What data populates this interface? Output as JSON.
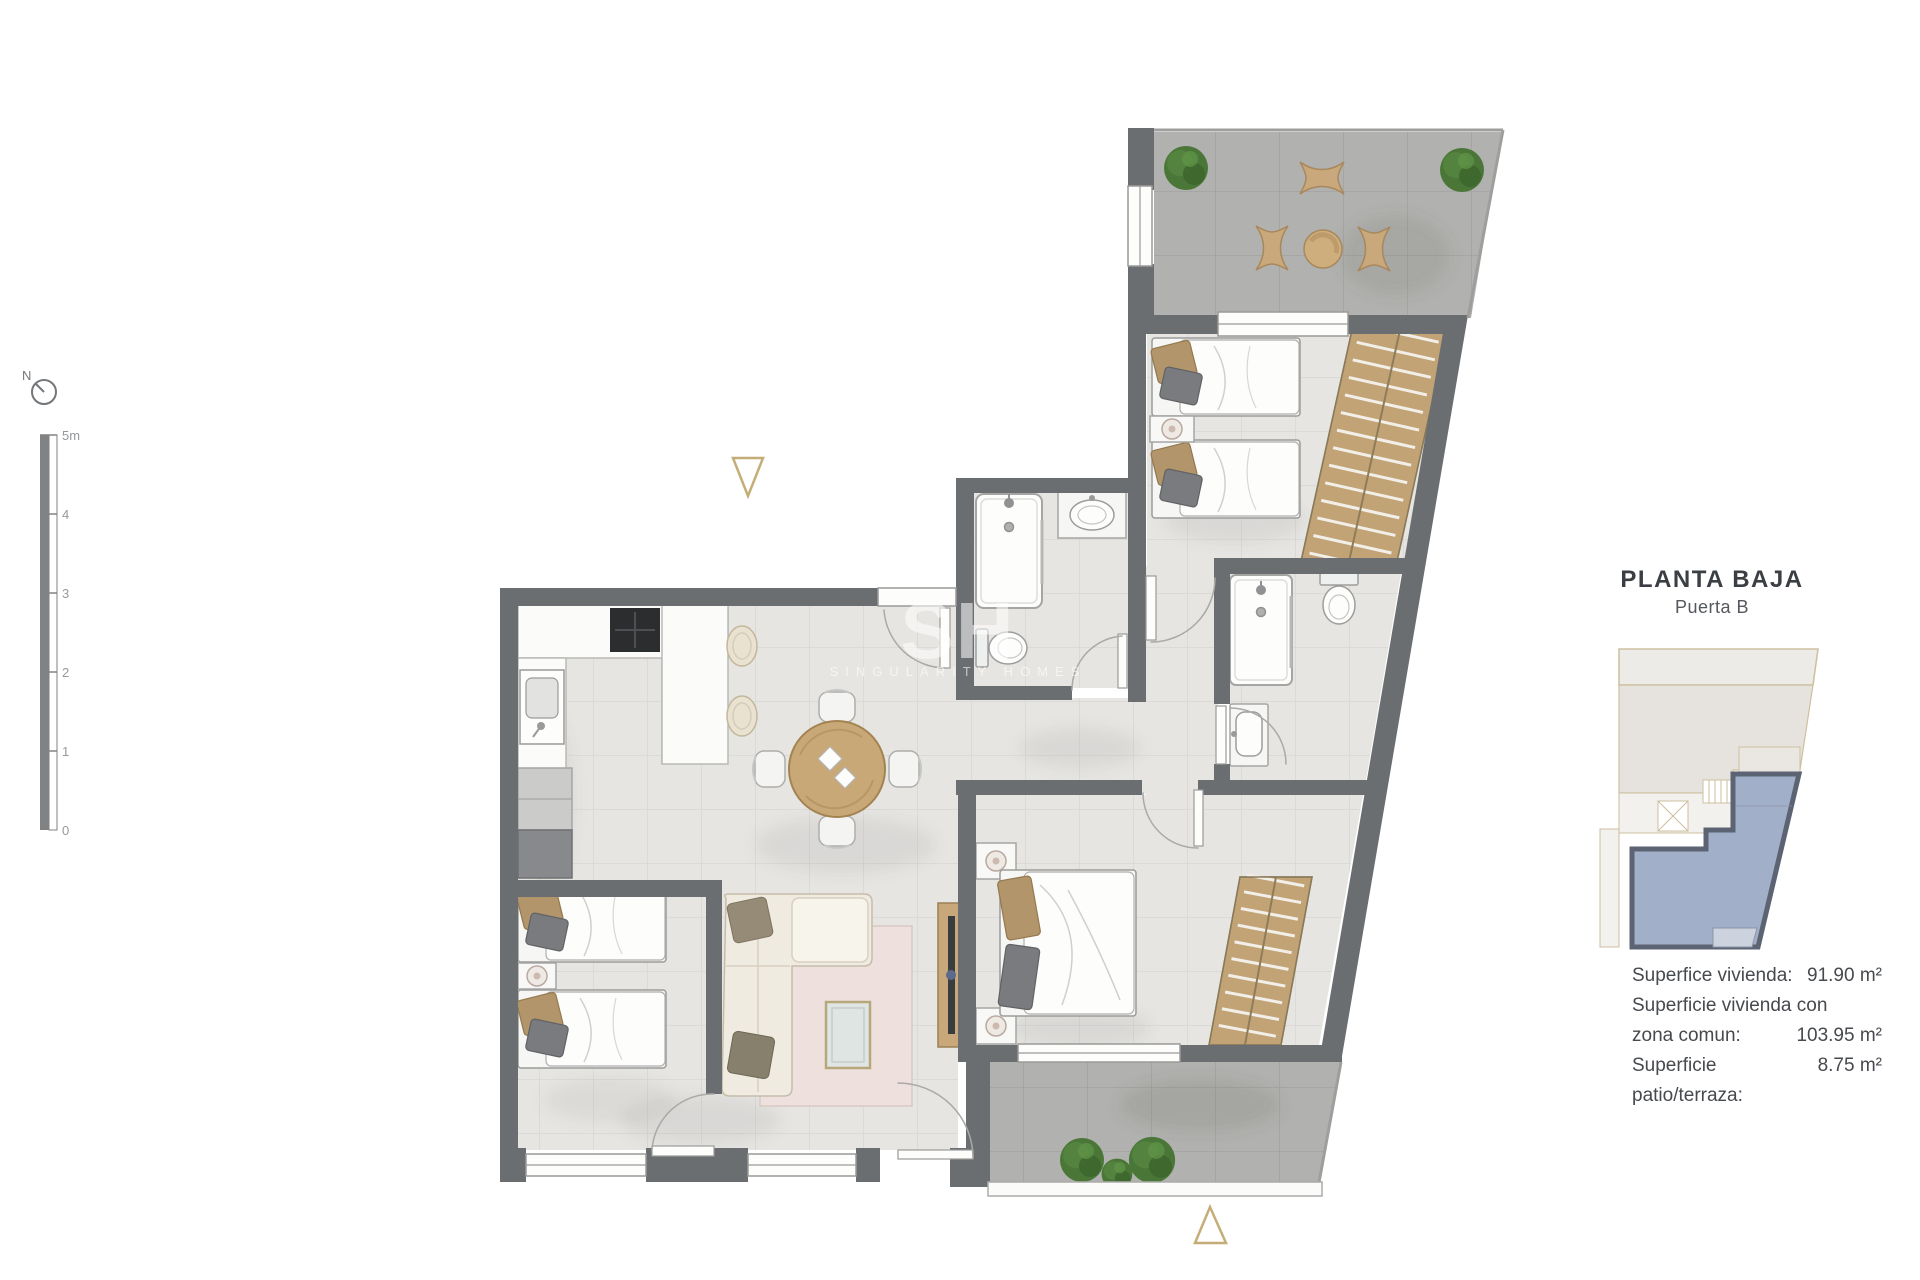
{
  "title_block": {
    "title": "PLANTA BAJA",
    "subtitle": "Puerta B"
  },
  "areas": {
    "rows": [
      {
        "label": "Superfice vivienda:",
        "value": "91.90 m²"
      },
      {
        "label": "Superficie vivienda con",
        "value": ""
      },
      {
        "label": "zona comun:",
        "value": "103.95 m²"
      },
      {
        "label": "Superficie patio/terraza:",
        "value": "8.75 m²"
      }
    ]
  },
  "compass": {
    "label": "N"
  },
  "scale_bar": {
    "ticks": [
      "5m",
      "4",
      "3",
      "2",
      "1",
      "0"
    ]
  },
  "watermark": {
    "initials": "SH",
    "name": "SINGULARITY HOMES"
  },
  "colors": {
    "wall": "#6b6e71",
    "floor": "#e6e5e2",
    "terrace_floor": "#b1b1af",
    "wood": "#c9a878",
    "marker_tan": "#c4ad77",
    "highlight_fill": "#a2afc8",
    "highlight_border": "#5c6373",
    "text": "#3b3f43"
  }
}
